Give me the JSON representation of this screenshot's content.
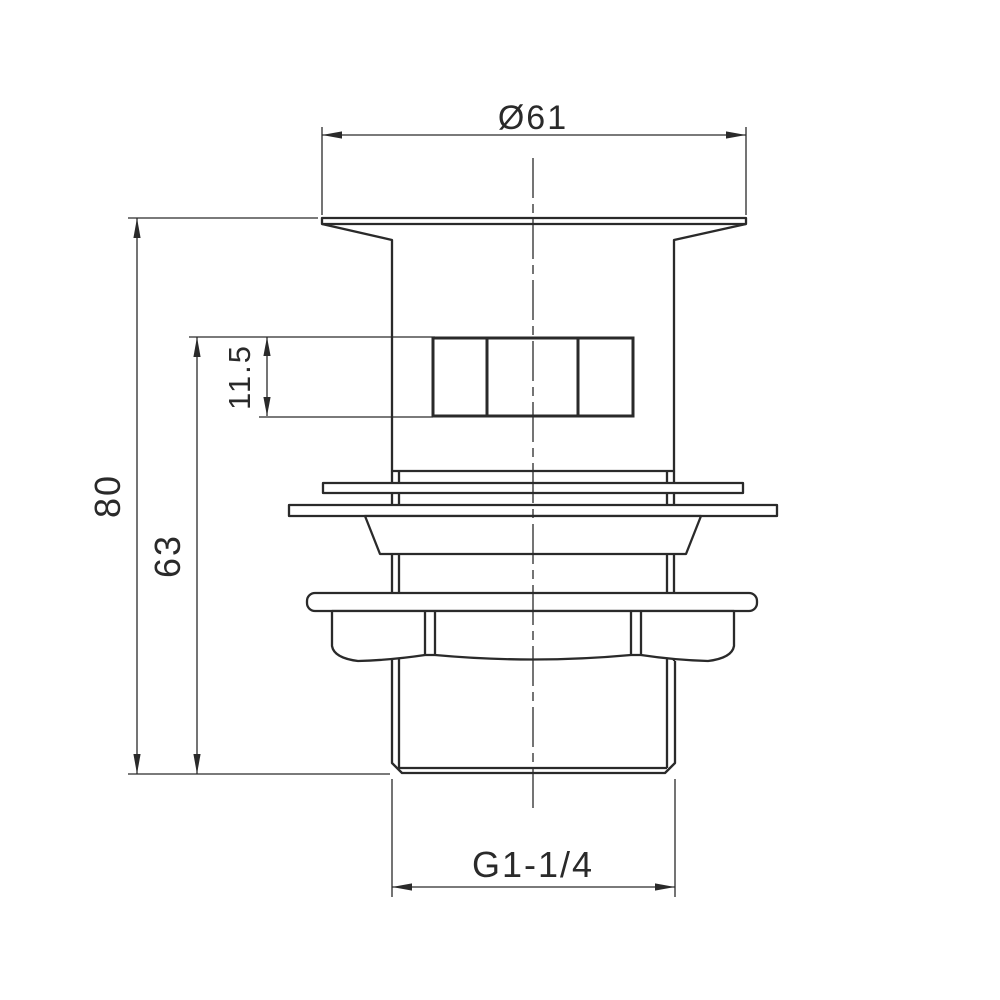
{
  "drawing": {
    "colors": {
      "line": "#2a2a2a",
      "background": "#ffffff"
    },
    "dimensions": {
      "top_diameter": "Ø61",
      "overall_height": "80",
      "body_height": "63",
      "overflow_slot_height": "11.5",
      "thread_size": "G1-1/4"
    }
  }
}
